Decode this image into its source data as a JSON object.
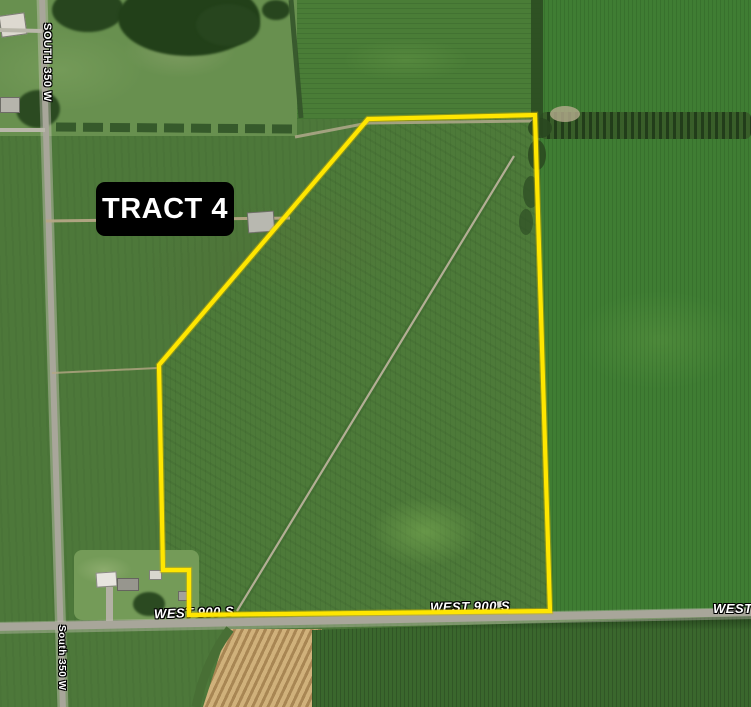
{
  "tract": {
    "label": "TRACT 4"
  },
  "roads": {
    "south_350w_upper": "SOUTH 350 W",
    "south_350w_lower": "South 350 W",
    "west_900s_left": "WEST 900 S",
    "west_900s_center": "WEST 900 S",
    "west_900s_right": "WEST 900 S"
  },
  "boundary": {
    "points": "368,119 535,115 550,611 189,615 189,570 163,570 159,365",
    "stroke": "#ffe600",
    "underlay_stroke": "#c8b000"
  },
  "colors": {
    "label_bg": "#000000",
    "label_text": "#ffffff",
    "road_gray": "#a8a69a",
    "field_base": "#4d783a",
    "ditch_tan": "#b3ae95"
  }
}
